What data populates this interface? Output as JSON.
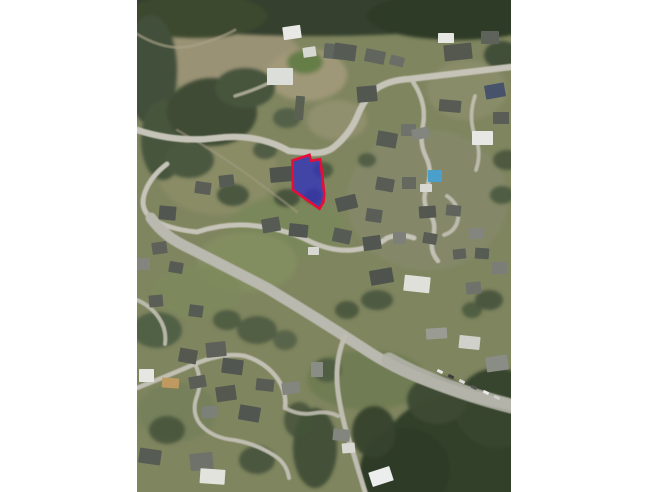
{
  "page": {
    "background": "#ffffff",
    "width": 648,
    "height": 492
  },
  "map": {
    "left": 137,
    "top": 0,
    "width": 374,
    "height": 492,
    "base_color": "#7f855f",
    "palette": {
      "forest_dark": "#33402b",
      "field_green": "#7e8a5c",
      "dirt_pale": "#9a9274",
      "road_gray": "#c6c4b8",
      "building_dark": "#565b54",
      "building_white": "#e8e9e4",
      "pool_blue": "#4a9fcb",
      "parcel_fill": "#3434b8",
      "parcel_stroke": "#ea0c38"
    },
    "terrain": [
      {
        "cx": 95,
        "cy": 60,
        "rx": 70,
        "ry": 40,
        "c": "#9a9274",
        "o": 1
      },
      {
        "cx": 170,
        "cy": 75,
        "rx": 40,
        "ry": 26,
        "c": "#a39a7a",
        "o": 0.9
      },
      {
        "cx": 200,
        "cy": 120,
        "rx": 30,
        "ry": 20,
        "c": "#969272",
        "o": 0.8
      },
      {
        "cx": 330,
        "cy": 90,
        "rx": 40,
        "ry": 30,
        "c": "#8b8e6c",
        "o": 0.7
      },
      {
        "cx": 80,
        "cy": 170,
        "rx": 60,
        "ry": 45,
        "c": "#8a8c66",
        "o": 1
      },
      {
        "cx": 290,
        "cy": 200,
        "rx": 80,
        "ry": 70,
        "c": "#86896a",
        "o": 0.8
      },
      {
        "cx": 150,
        "cy": 228,
        "rx": 58,
        "ry": 32,
        "c": "#7a875a",
        "o": 1
      },
      {
        "cx": 110,
        "cy": 262,
        "rx": 50,
        "ry": 30,
        "c": "#828d60",
        "o": 1
      },
      {
        "cx": 60,
        "cy": 292,
        "rx": 45,
        "ry": 25,
        "c": "#7d8a5c",
        "o": 0.9
      },
      {
        "cx": 168,
        "cy": 62,
        "rx": 18,
        "ry": 12,
        "c": "#5f7a43",
        "o": 0.9
      },
      {
        "cx": 230,
        "cy": 380,
        "rx": 60,
        "ry": 30,
        "c": "#6f7b51",
        "o": 0.9
      },
      {
        "cx": 40,
        "cy": 412,
        "rx": 40,
        "ry": 30,
        "c": "#76815b",
        "o": 0.9
      }
    ],
    "forests": [
      {
        "cx": 180,
        "cy": 10,
        "rx": 210,
        "ry": 26,
        "c": "#35402d",
        "o": 1
      },
      {
        "cx": 60,
        "cy": 16,
        "rx": 70,
        "ry": 22,
        "c": "#3c482f",
        "o": 1
      },
      {
        "cx": 320,
        "cy": 16,
        "rx": 90,
        "ry": 24,
        "c": "#2f3a28",
        "o": 1
      },
      {
        "cx": 14,
        "cy": 70,
        "rx": 26,
        "ry": 55,
        "c": "#42503a",
        "o": 1
      },
      {
        "cx": 26,
        "cy": 140,
        "rx": 22,
        "ry": 40,
        "c": "#47553d",
        "o": 1
      },
      {
        "cx": 75,
        "cy": 112,
        "rx": 45,
        "ry": 34,
        "c": "#3f4c36",
        "o": 1
      },
      {
        "cx": 108,
        "cy": 88,
        "rx": 30,
        "ry": 20,
        "c": "#46543c",
        "o": 1
      },
      {
        "cx": 52,
        "cy": 160,
        "rx": 25,
        "ry": 18,
        "c": "#4b5941",
        "o": 1
      },
      {
        "cx": 150,
        "cy": 118,
        "rx": 14,
        "ry": 10,
        "c": "#4f5d45",
        "o": 0.9
      },
      {
        "cx": 128,
        "cy": 150,
        "rx": 12,
        "ry": 9,
        "c": "#4a5840",
        "o": 0.9
      },
      {
        "cx": 96,
        "cy": 195,
        "rx": 16,
        "ry": 11,
        "c": "#44523a",
        "o": 0.9
      },
      {
        "cx": 150,
        "cy": 198,
        "rx": 13,
        "ry": 9,
        "c": "#42503a",
        "o": 0.9
      },
      {
        "cx": 186,
        "cy": 170,
        "rx": 10,
        "ry": 8,
        "c": "#47553d",
        "o": 0.85
      },
      {
        "cx": 176,
        "cy": 196,
        "rx": 9,
        "ry": 7,
        "c": "#3a4731",
        "o": 0.9
      },
      {
        "cx": 230,
        "cy": 160,
        "rx": 9,
        "ry": 7,
        "c": "#4a5840",
        "o": 0.85
      },
      {
        "cx": 365,
        "cy": 55,
        "rx": 18,
        "ry": 14,
        "c": "#3c4833",
        "o": 0.9
      },
      {
        "cx": 370,
        "cy": 160,
        "rx": 14,
        "ry": 10,
        "c": "#44523a",
        "o": 0.85
      },
      {
        "cx": 365,
        "cy": 195,
        "rx": 12,
        "ry": 9,
        "c": "#47553d",
        "o": 0.85
      },
      {
        "cx": 352,
        "cy": 300,
        "rx": 14,
        "ry": 10,
        "c": "#42503a",
        "o": 0.85
      },
      {
        "cx": 335,
        "cy": 310,
        "rx": 10,
        "ry": 8,
        "c": "#46543c",
        "o": 0.8
      },
      {
        "cx": 240,
        "cy": 300,
        "rx": 16,
        "ry": 10,
        "c": "#46543c",
        "o": 0.85
      },
      {
        "cx": 210,
        "cy": 310,
        "rx": 12,
        "ry": 9,
        "c": "#42503a",
        "o": 0.8
      },
      {
        "cx": 320,
        "cy": 455,
        "rx": 75,
        "ry": 60,
        "c": "#33402b",
        "o": 1
      },
      {
        "cx": 268,
        "cy": 470,
        "rx": 45,
        "ry": 42,
        "c": "#2f3b28",
        "o": 1
      },
      {
        "cx": 360,
        "cy": 408,
        "rx": 42,
        "ry": 40,
        "c": "#38452f",
        "o": 1
      },
      {
        "cx": 300,
        "cy": 400,
        "rx": 30,
        "ry": 24,
        "c": "#3d4a33",
        "o": 0.95
      },
      {
        "cx": 237,
        "cy": 432,
        "rx": 22,
        "ry": 26,
        "c": "#36422d",
        "o": 0.95
      },
      {
        "cx": 178,
        "cy": 448,
        "rx": 22,
        "ry": 40,
        "c": "#3d4a33",
        "o": 0.9
      },
      {
        "cx": 162,
        "cy": 420,
        "rx": 15,
        "ry": 18,
        "c": "#44523a",
        "o": 0.85
      },
      {
        "cx": 190,
        "cy": 370,
        "rx": 14,
        "ry": 12,
        "c": "#47553d",
        "o": 0.8
      },
      {
        "cx": 20,
        "cy": 330,
        "rx": 25,
        "ry": 18,
        "c": "#4e5c43",
        "o": 0.9
      },
      {
        "cx": 120,
        "cy": 330,
        "rx": 20,
        "ry": 14,
        "c": "#4a5840",
        "o": 0.85
      },
      {
        "cx": 90,
        "cy": 320,
        "rx": 14,
        "ry": 10,
        "c": "#46543c",
        "o": 0.8
      },
      {
        "cx": 30,
        "cy": 430,
        "rx": 18,
        "ry": 14,
        "c": "#44523a",
        "o": 0.85
      },
      {
        "cx": 120,
        "cy": 460,
        "rx": 18,
        "ry": 14,
        "c": "#42503a",
        "o": 0.85
      },
      {
        "cx": 148,
        "cy": 340,
        "rx": 12,
        "ry": 10,
        "c": "#4f5d45",
        "o": 0.8
      }
    ],
    "roads": [
      {
        "d": "M0,34 Q30,52 55,46 Q80,40 98,30",
        "w": 3,
        "c": "#a9a288",
        "o": 0.65
      },
      {
        "d": "M40,130 Q80,152 118,180 Q148,202 160,212",
        "w": 2.5,
        "c": "#a39b80",
        "o": 0.55
      },
      {
        "d": "M0,130 Q40,143 80,138 Q120,133 152,151 L176,153 Q190,153 197,147 Q212,135 220,117 Q228,97 239,89 Q252,80 272,79 L374,67",
        "w": 6.5,
        "c": "#c6c4b8",
        "o": 1
      },
      {
        "d": "M98,96 Q118,90 134,82",
        "w": 3.5,
        "c": "#beb9a8",
        "o": 0.8
      },
      {
        "d": "M276,82 Q290,103 286,125 Q282,143 289,157 Q296,171 290,187 Q284,201 292,213 Q300,223 296,237 Q292,251 301,261",
        "w": 4.5,
        "c": "#c2c0b4",
        "o": 1
      },
      {
        "d": "M338,96 Q331,117 338,136 Q345,153 339,170",
        "w": 3.8,
        "c": "#c2c0b4",
        "o": 0.9
      },
      {
        "d": "M310,196 Q323,205 321,219 Q319,231 307,235",
        "w": 4,
        "c": "#c2c0b4",
        "o": 0.9
      },
      {
        "d": "M60,232 Q90,222 120,226 Q150,230 170,240 Q194,252 216,250 Q240,247 250,238 Q263,233 277,238",
        "w": 5,
        "c": "#c6c4b8",
        "o": 1
      },
      {
        "d": "M30,164 Q14,176 8,192 Q2,208 14,218 Q30,229 60,232",
        "w": 5,
        "c": "#c6c4b8",
        "o": 1
      },
      {
        "d": "M14,218 Q26,235 46,245 Q82,263 130,288 Q180,318 226,348 Q282,386 374,405",
        "w": 11,
        "c": "#bab9af",
        "o": 1
      },
      {
        "d": "M252,360 Q300,387 374,406",
        "w": 15,
        "c": "#b3b2a8",
        "o": 0.9
      },
      {
        "d": "M208,336 Q197,362 201,392 Q205,422 216,452 L228,492",
        "w": 5,
        "c": "#bfbdb1",
        "o": 1
      },
      {
        "d": "M0,388 Q30,376 58,364 Q86,352 108,356 Q128,362 140,378 Q150,392 148,408",
        "w": 4.5,
        "c": "#c2c0b4",
        "o": 1
      },
      {
        "d": "M58,364 Q66,380 60,396 Q54,412 63,424 Q75,438 97,440 Q120,444 138,456 Q150,464 152,478",
        "w": 4,
        "c": "#bfbdb1",
        "o": 1
      },
      {
        "d": "M0,300 Q14,306 22,318 Q30,330 28,344",
        "w": 4,
        "c": "#c2c0b4",
        "o": 0.9
      },
      {
        "d": "M148,408 Q162,416 178,413 Q192,411 201,416",
        "w": 4,
        "c": "#bfbdb1",
        "o": 0.9
      }
    ],
    "buildings": [
      {
        "x": 146,
        "y": 26,
        "w": 18,
        "h": 13,
        "r": -8,
        "c": "#e8e9e4"
      },
      {
        "x": 166,
        "y": 47,
        "w": 13,
        "h": 10,
        "r": -8,
        "c": "#d8d8d2"
      },
      {
        "x": 130,
        "y": 68,
        "w": 26,
        "h": 17,
        "r": 0,
        "c": "#dcded9"
      },
      {
        "x": 187,
        "y": 44,
        "w": 20,
        "h": 15,
        "r": 6,
        "c": "#60655e"
      },
      {
        "x": 158,
        "y": 96,
        "w": 9,
        "h": 24,
        "r": 5,
        "c": "#5a6152"
      },
      {
        "x": 197,
        "y": 44,
        "w": 22,
        "h": 16,
        "r": 8,
        "c": "#565b54"
      },
      {
        "x": 228,
        "y": 50,
        "w": 20,
        "h": 13,
        "r": 12,
        "c": "#60655e"
      },
      {
        "x": 301,
        "y": 33,
        "w": 16,
        "h": 10,
        "r": 0,
        "c": "#e6e7e2"
      },
      {
        "x": 253,
        "y": 56,
        "w": 14,
        "h": 10,
        "r": 15,
        "c": "#6a6e66"
      },
      {
        "x": 307,
        "y": 44,
        "w": 28,
        "h": 16,
        "r": -6,
        "c": "#54584f"
      },
      {
        "x": 344,
        "y": 31,
        "w": 18,
        "h": 13,
        "r": 0,
        "c": "#5d625b"
      },
      {
        "x": 348,
        "y": 84,
        "w": 20,
        "h": 14,
        "r": -10,
        "c": "#47536b"
      },
      {
        "x": 302,
        "y": 100,
        "w": 22,
        "h": 12,
        "r": 5,
        "c": "#575b53"
      },
      {
        "x": 220,
        "y": 86,
        "w": 20,
        "h": 16,
        "r": -5,
        "c": "#525750"
      },
      {
        "x": 264,
        "y": 124,
        "w": 15,
        "h": 12,
        "r": 0,
        "c": "#6e726a"
      },
      {
        "x": 240,
        "y": 132,
        "w": 20,
        "h": 15,
        "r": 10,
        "c": "#565b54"
      },
      {
        "x": 275,
        "y": 128,
        "w": 17,
        "h": 11,
        "r": -12,
        "c": "#83867e"
      },
      {
        "x": 335,
        "y": 131,
        "w": 21,
        "h": 14,
        "r": 0,
        "c": "#e7e8e3"
      },
      {
        "x": 356,
        "y": 112,
        "w": 16,
        "h": 12,
        "r": 0,
        "c": "#595d56"
      },
      {
        "x": 133,
        "y": 167,
        "w": 22,
        "h": 15,
        "r": -5,
        "c": "#4e534d"
      },
      {
        "x": 239,
        "y": 178,
        "w": 18,
        "h": 13,
        "r": 10,
        "c": "#585c55"
      },
      {
        "x": 265,
        "y": 177,
        "w": 14,
        "h": 12,
        "r": 0,
        "c": "#64685f"
      },
      {
        "x": 291,
        "y": 170,
        "w": 14,
        "h": 12,
        "r": 0,
        "c": "#4a9fcb"
      },
      {
        "x": 283,
        "y": 184,
        "w": 12,
        "h": 8,
        "r": 0,
        "c": "#d7d8d2"
      },
      {
        "x": 199,
        "y": 196,
        "w": 21,
        "h": 14,
        "r": -14,
        "c": "#515650"
      },
      {
        "x": 229,
        "y": 209,
        "w": 16,
        "h": 13,
        "r": 8,
        "c": "#5a5e57"
      },
      {
        "x": 282,
        "y": 206,
        "w": 17,
        "h": 12,
        "r": -4,
        "c": "#53574f"
      },
      {
        "x": 309,
        "y": 205,
        "w": 15,
        "h": 11,
        "r": 6,
        "c": "#60645c"
      },
      {
        "x": 196,
        "y": 229,
        "w": 18,
        "h": 14,
        "r": 12,
        "c": "#565b54"
      },
      {
        "x": 226,
        "y": 236,
        "w": 18,
        "h": 14,
        "r": -8,
        "c": "#515650"
      },
      {
        "x": 256,
        "y": 232,
        "w": 13,
        "h": 12,
        "r": 0,
        "c": "#7d8078"
      },
      {
        "x": 286,
        "y": 233,
        "w": 14,
        "h": 11,
        "r": 10,
        "c": "#585c55"
      },
      {
        "x": 332,
        "y": 228,
        "w": 14,
        "h": 11,
        "r": 0,
        "c": "#83867e"
      },
      {
        "x": 316,
        "y": 249,
        "w": 13,
        "h": 10,
        "r": -6,
        "c": "#5d615a"
      },
      {
        "x": 338,
        "y": 248,
        "w": 14,
        "h": 11,
        "r": 4,
        "c": "#565b54"
      },
      {
        "x": 355,
        "y": 262,
        "w": 15,
        "h": 12,
        "r": 0,
        "c": "#7b7e76"
      },
      {
        "x": 233,
        "y": 269,
        "w": 23,
        "h": 15,
        "r": -10,
        "c": "#4e534d"
      },
      {
        "x": 267,
        "y": 276,
        "w": 26,
        "h": 16,
        "r": 6,
        "c": "#dfe0da"
      },
      {
        "x": 329,
        "y": 282,
        "w": 15,
        "h": 12,
        "r": -5,
        "c": "#6e726a"
      },
      {
        "x": 125,
        "y": 218,
        "w": 18,
        "h": 14,
        "r": -10,
        "c": "#565b54"
      },
      {
        "x": 152,
        "y": 224,
        "w": 19,
        "h": 13,
        "r": 6,
        "c": "#515650"
      },
      {
        "x": 171,
        "y": 247,
        "w": 11,
        "h": 8,
        "r": 0,
        "c": "#d8d9d3"
      },
      {
        "x": 58,
        "y": 182,
        "w": 16,
        "h": 12,
        "r": 8,
        "c": "#5a5e57"
      },
      {
        "x": 82,
        "y": 175,
        "w": 15,
        "h": 12,
        "r": -6,
        "c": "#565b54"
      },
      {
        "x": 22,
        "y": 206,
        "w": 17,
        "h": 14,
        "r": 5,
        "c": "#515650"
      },
      {
        "x": 15,
        "y": 242,
        "w": 15,
        "h": 12,
        "r": -8,
        "c": "#5d615a"
      },
      {
        "x": 0,
        "y": 258,
        "w": 13,
        "h": 12,
        "r": 0,
        "c": "#83867e"
      },
      {
        "x": 32,
        "y": 262,
        "w": 14,
        "h": 11,
        "r": 10,
        "c": "#565b54"
      },
      {
        "x": 12,
        "y": 295,
        "w": 14,
        "h": 12,
        "r": -5,
        "c": "#5a5e57"
      },
      {
        "x": 52,
        "y": 305,
        "w": 14,
        "h": 12,
        "r": 8,
        "c": "#565b54"
      },
      {
        "x": 42,
        "y": 349,
        "w": 18,
        "h": 14,
        "r": 10,
        "c": "#54584f"
      },
      {
        "x": 69,
        "y": 342,
        "w": 20,
        "h": 15,
        "r": -6,
        "c": "#5d615a"
      },
      {
        "x": 85,
        "y": 359,
        "w": 21,
        "h": 15,
        "r": 8,
        "c": "#515650"
      },
      {
        "x": 52,
        "y": 376,
        "w": 17,
        "h": 12,
        "r": -10,
        "c": "#5a5e57"
      },
      {
        "x": 25,
        "y": 378,
        "w": 17,
        "h": 10,
        "r": 4,
        "c": "#bf9a60"
      },
      {
        "x": 2,
        "y": 369,
        "w": 15,
        "h": 13,
        "r": 0,
        "c": "#e6e7e2"
      },
      {
        "x": 79,
        "y": 386,
        "w": 20,
        "h": 15,
        "r": -8,
        "c": "#54584f"
      },
      {
        "x": 102,
        "y": 406,
        "w": 21,
        "h": 15,
        "r": 10,
        "c": "#515650"
      },
      {
        "x": 65,
        "y": 406,
        "w": 15,
        "h": 12,
        "r": -4,
        "c": "#7d8078"
      },
      {
        "x": 119,
        "y": 379,
        "w": 18,
        "h": 12,
        "r": 6,
        "c": "#585c55"
      },
      {
        "x": 145,
        "y": 382,
        "w": 18,
        "h": 12,
        "r": -8,
        "c": "#83867e"
      },
      {
        "x": 174,
        "y": 362,
        "w": 12,
        "h": 15,
        "r": 0,
        "c": "#8a8d85"
      },
      {
        "x": 53,
        "y": 453,
        "w": 23,
        "h": 17,
        "r": -6,
        "c": "#6e726a"
      },
      {
        "x": 63,
        "y": 469,
        "w": 25,
        "h": 15,
        "r": 4,
        "c": "#e2e3dd"
      },
      {
        "x": 2,
        "y": 449,
        "w": 22,
        "h": 15,
        "r": 8,
        "c": "#565b54"
      },
      {
        "x": 289,
        "y": 328,
        "w": 21,
        "h": 11,
        "r": -4,
        "c": "#9a9c94"
      },
      {
        "x": 322,
        "y": 336,
        "w": 21,
        "h": 13,
        "r": 6,
        "c": "#d0d1cb"
      },
      {
        "x": 349,
        "y": 356,
        "w": 22,
        "h": 15,
        "r": -8,
        "c": "#8a8d85"
      },
      {
        "x": 233,
        "y": 469,
        "w": 22,
        "h": 15,
        "r": -18,
        "c": "#eceded"
      },
      {
        "x": 196,
        "y": 429,
        "w": 17,
        "h": 12,
        "r": 6,
        "c": "#83867e"
      },
      {
        "x": 205,
        "y": 443,
        "w": 13,
        "h": 10,
        "r": -5,
        "c": "#d8d9d3"
      }
    ],
    "cars": [
      {
        "x": 300,
        "y": 370,
        "c": "#e8e8e6"
      },
      {
        "x": 311,
        "y": 375,
        "c": "#3c3c3c"
      },
      {
        "x": 322,
        "y": 380,
        "c": "#dcdcda"
      },
      {
        "x": 334,
        "y": 386,
        "c": "#565656"
      },
      {
        "x": 346,
        "y": 391,
        "c": "#eaeaea"
      },
      {
        "x": 357,
        "y": 396,
        "c": "#cfcfcd"
      }
    ],
    "car_size": {
      "w": 6,
      "h": 3,
      "rot": 27
    },
    "parcel": {
      "points": [
        [
          155.5,
          160.5
        ],
        [
          172.5,
          154.8
        ],
        [
          173.8,
          160.8
        ],
        [
          183.2,
          159.2
        ],
        [
          187.3,
          194.0
        ],
        [
          186.5,
          202.0
        ],
        [
          182.5,
          208.8
        ],
        [
          156.0,
          190.0
        ]
      ],
      "fill": "#3434b8",
      "fill_opacity": 0.8,
      "stroke": "#ea0c38",
      "stroke_width": 2.6
    }
  }
}
